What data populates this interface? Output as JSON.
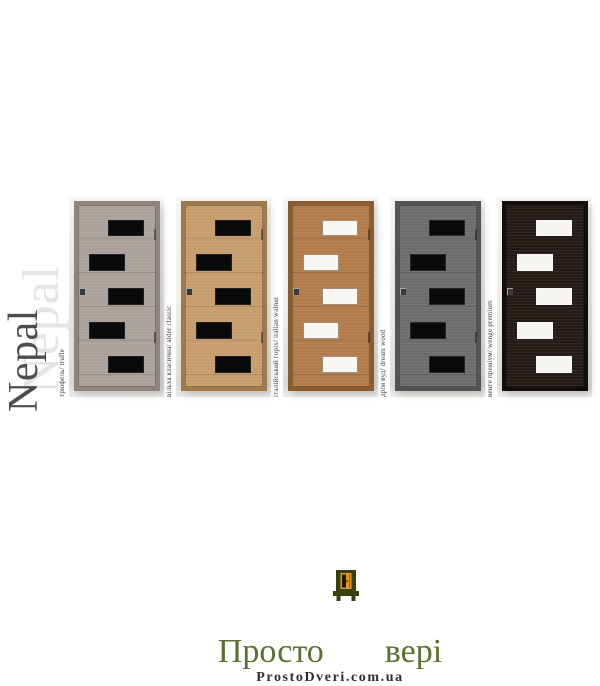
{
  "product": {
    "model_name": "Nepal",
    "watermark_light": "Nepal",
    "watermark_dark": "Nepal"
  },
  "doors": [
    {
      "id": "truffle",
      "finish_label": "трюфель/ trufle",
      "glass_type": "black",
      "colors": {
        "base": "#aaa19b",
        "frame": "#8e857f",
        "bg": "#e9e6e3",
        "glass": "#0a0a0a",
        "glass_border": "rgba(255,255,255,0.10)"
      }
    },
    {
      "id": "alder-classic",
      "finish_label": "вільха класична/ alder classic",
      "glass_type": "black",
      "colors": {
        "base": "#c69d6e",
        "frame": "#a0794c",
        "bg": "#f3f1ee",
        "glass": "#0a0a0a",
        "glass_border": "rgba(255,255,255,0.10)"
      }
    },
    {
      "id": "italian-walnut",
      "finish_label": "італійський горіх/ italian walnut",
      "glass_type": "white",
      "colors": {
        "base": "#b17c49",
        "frame": "#8a5c30",
        "bg": "#f4f2ef",
        "glass": "#f7f6f3",
        "glass_border": "rgba(90,55,25,0.55)"
      }
    },
    {
      "id": "dream-wood",
      "finish_label": "дрім вуд/ dream wood",
      "glass_type": "black",
      "colors": {
        "base": "#6f6c6d",
        "frame": "#565354",
        "bg": "#efedeb",
        "glass": "#0a0a0a",
        "glass_border": "rgba(255,255,255,0.12)"
      }
    },
    {
      "id": "wenge-premium",
      "finish_label": "венге преміум/ wenge premium",
      "glass_type": "white",
      "colors": {
        "base": "#251b16",
        "frame": "#140e0b",
        "bg": "#f1efec",
        "glass": "#f6f5f2",
        "glass_border": "rgba(255,255,255,0.25)"
      }
    }
  ],
  "logo": {
    "word_left": "Просто",
    "word_right": "вері",
    "full_name": "Просто Двері",
    "url": "ProstoDveri.com.ua",
    "colors": {
      "green": "#5c7031",
      "dark_green": "#36410f",
      "orange": "#e5991d",
      "url_text": "#2e2d2b"
    }
  }
}
